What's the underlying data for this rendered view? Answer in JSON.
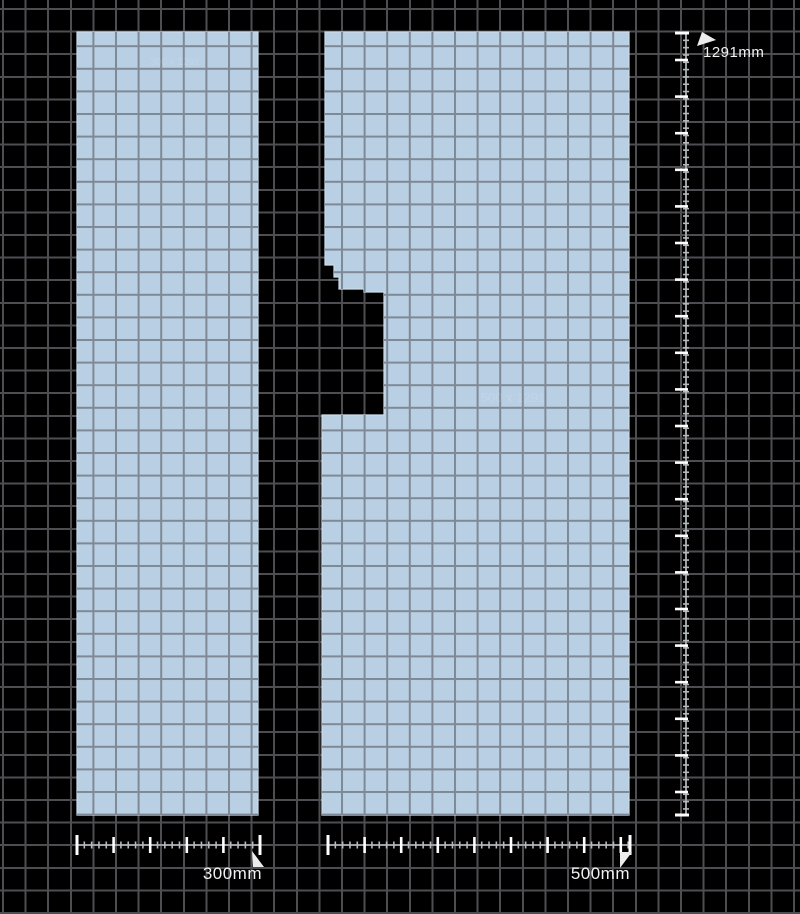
{
  "canvas": {
    "width": 800,
    "height": 914,
    "background_color": "#000000",
    "grid": {
      "cell_size_px": 22.6,
      "line_color": "#4e4e52",
      "piece_grid_line_color": "#7f8995"
    }
  },
  "pieces": [
    {
      "name": "panel-300mm",
      "fill": "#b9cfe4",
      "edge": "#cddcea",
      "points": "77,32 258,32 258,815 77,815",
      "faint_label": "300 x 1291"
    },
    {
      "name": "panel-500mm",
      "fill": "#b9cfe4",
      "edge": "#cddcea",
      "points": "325,32 629,32 629,815 322,815 322,415 384,415 384,292 364,292 364,289 339,289 339,277 334,277 334,265 325,265",
      "faint_label": "500 x 1291"
    }
  ],
  "rulers": [
    {
      "id": "height-ruler",
      "orientation": "vertical",
      "x": 686,
      "from": 33,
      "to": 815,
      "major_spacing": 36.6,
      "major_phase": 27,
      "minor_spacing": 7.32,
      "label": "1291mm",
      "flag_points": "697,46 702,32 716,40"
    },
    {
      "id": "width-ruler-left",
      "orientation": "horizontal",
      "y": 845,
      "from": 77,
      "to": 260,
      "major_spacing": 36.6,
      "major_phase": 36.6,
      "minor_spacing": 7.32,
      "label": "300mm",
      "flag_points": "252,851 264,867 253,867"
    },
    {
      "id": "width-ruler-right",
      "orientation": "horizontal",
      "y": 845,
      "from": 328,
      "to": 630,
      "major_spacing": 36.6,
      "major_phase": 36.6,
      "minor_spacing": 7.32,
      "label": "500mm",
      "flag_points": "620,852 632,852 620,868"
    }
  ],
  "colors": {
    "ruler_line": "#9aa0a6",
    "ruler_minor_tick": "#b9b9b9",
    "ruler_major_tick": "#ffffff",
    "flag_fill": "#ececec",
    "label_text": "#f2f2f2"
  }
}
